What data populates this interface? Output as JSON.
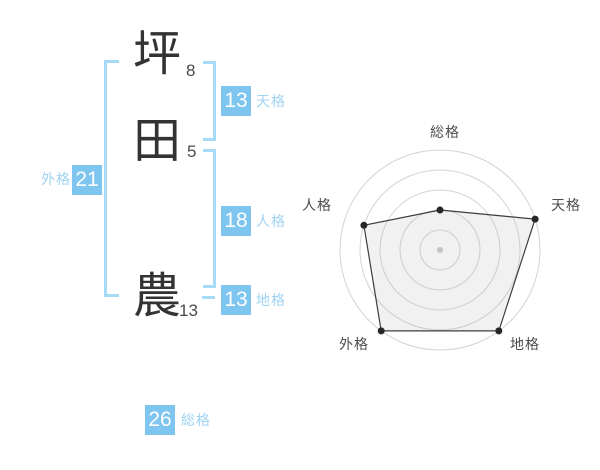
{
  "name_diagram": {
    "chars": [
      {
        "char": "坪",
        "strokes": "8"
      },
      {
        "char": "田",
        "strokes": "5"
      },
      {
        "char": "農",
        "strokes": "13"
      }
    ],
    "kaku": {
      "tenkaku": {
        "label": "天格",
        "value": "13"
      },
      "jinkaku": {
        "label": "人格",
        "value": "18"
      },
      "chikaku": {
        "label": "地格",
        "value": "13"
      },
      "gaikaku": {
        "label": "外格",
        "value": "21"
      },
      "soukaku": {
        "label": "総格",
        "value": "26"
      }
    }
  },
  "colors": {
    "accent_blue": "#7ec5f0",
    "label_blue": "#9fd3f3",
    "bracket_blue": "#a6daf6",
    "ring_gray": "#d4d4d4",
    "polygon_stroke": "#3d3d3d",
    "dot_color": "#262626",
    "center_dot": "#c2c2c2",
    "text_dark": "#333333"
  },
  "chart_data": {
    "type": "radar",
    "axes": [
      "総格",
      "天格",
      "地格",
      "外格",
      "人格"
    ],
    "scores": [
      2,
      5,
      5,
      5,
      4
    ],
    "max_score": 5,
    "rings": 5,
    "start_angle_deg": 90,
    "direction": "clockwise",
    "grid": "concentric-circles",
    "legend": "none"
  }
}
